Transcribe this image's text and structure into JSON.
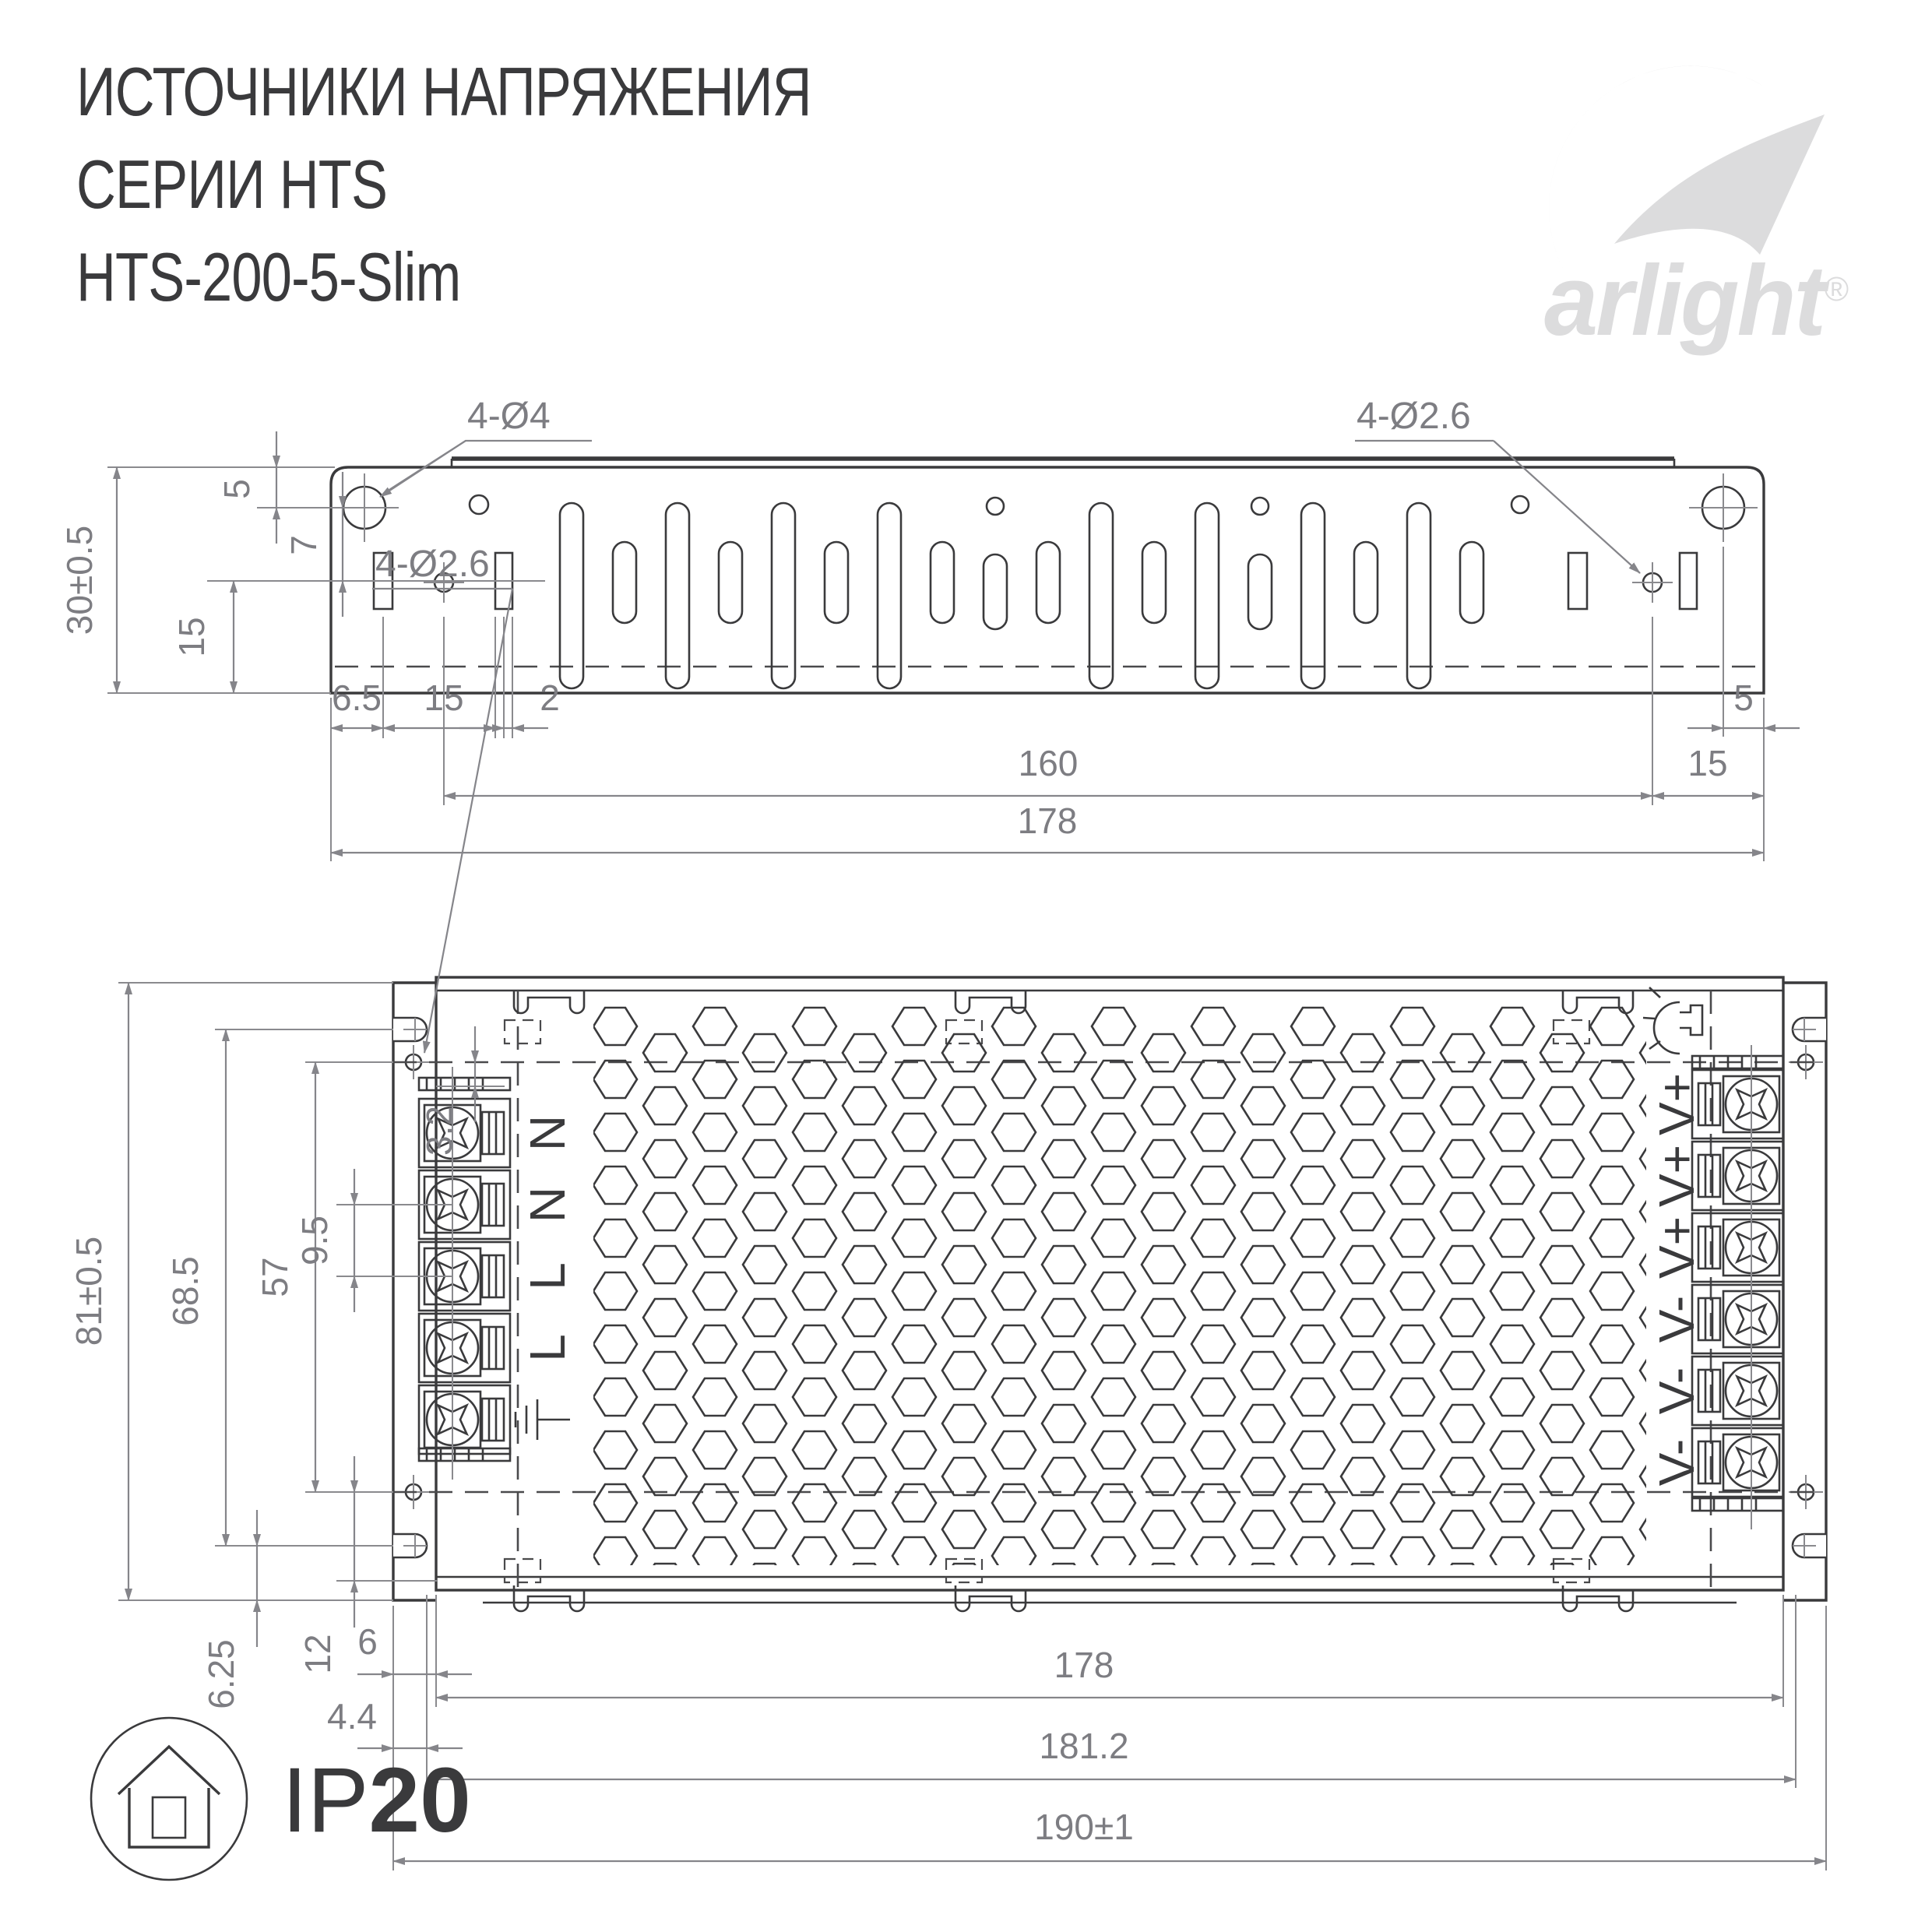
{
  "title": {
    "line1": "ИСТОЧНИКИ НАПРЯЖЕНИЯ",
    "line2": "СЕРИИ HTS",
    "line3": "HTS-200-5-Slim"
  },
  "logo": {
    "brand": "arlight",
    "registered": "®"
  },
  "colors": {
    "line": "#3a3a3c",
    "dimension": "#85858a",
    "logo": "#dcdcdd"
  },
  "drawing_side_view": {
    "hole_labels": {
      "large_holes": "4-Ø4",
      "small_holes": "4-Ø2.6"
    },
    "dims": {
      "height": "30±0.5",
      "top_offset": "5",
      "hole_to_slot": "7",
      "slot_to_bottom": "15",
      "left_margin": "6.5",
      "slot_pitch": "15",
      "slot_width": "2",
      "mount_span": "160",
      "length": "178",
      "right_hole_margin": "5",
      "right_pitch": "15"
    }
  },
  "drawing_top_view": {
    "hole_labels": {
      "small_holes": "4-Ø2.6"
    },
    "dims": {
      "height": "81±0.5",
      "notch_span": "68.5",
      "hole_span": "57",
      "hole_offset": "3.2",
      "terminal_pitch": "9.5",
      "notch_to_bottom": "6.25",
      "hole_to_bottom": "12",
      "side_offset": "6",
      "flange_offset": "4.4",
      "case_length": "178",
      "cover_length": "181.2",
      "overall_length": "190±1"
    },
    "terminals_input": [
      "N",
      "N",
      "L",
      "L",
      "⏚"
    ],
    "terminals_output": [
      "V+",
      "V+",
      "V+",
      "V-",
      "V-",
      "V-"
    ]
  },
  "badge": {
    "ip": "IP",
    "rating": "20"
  }
}
